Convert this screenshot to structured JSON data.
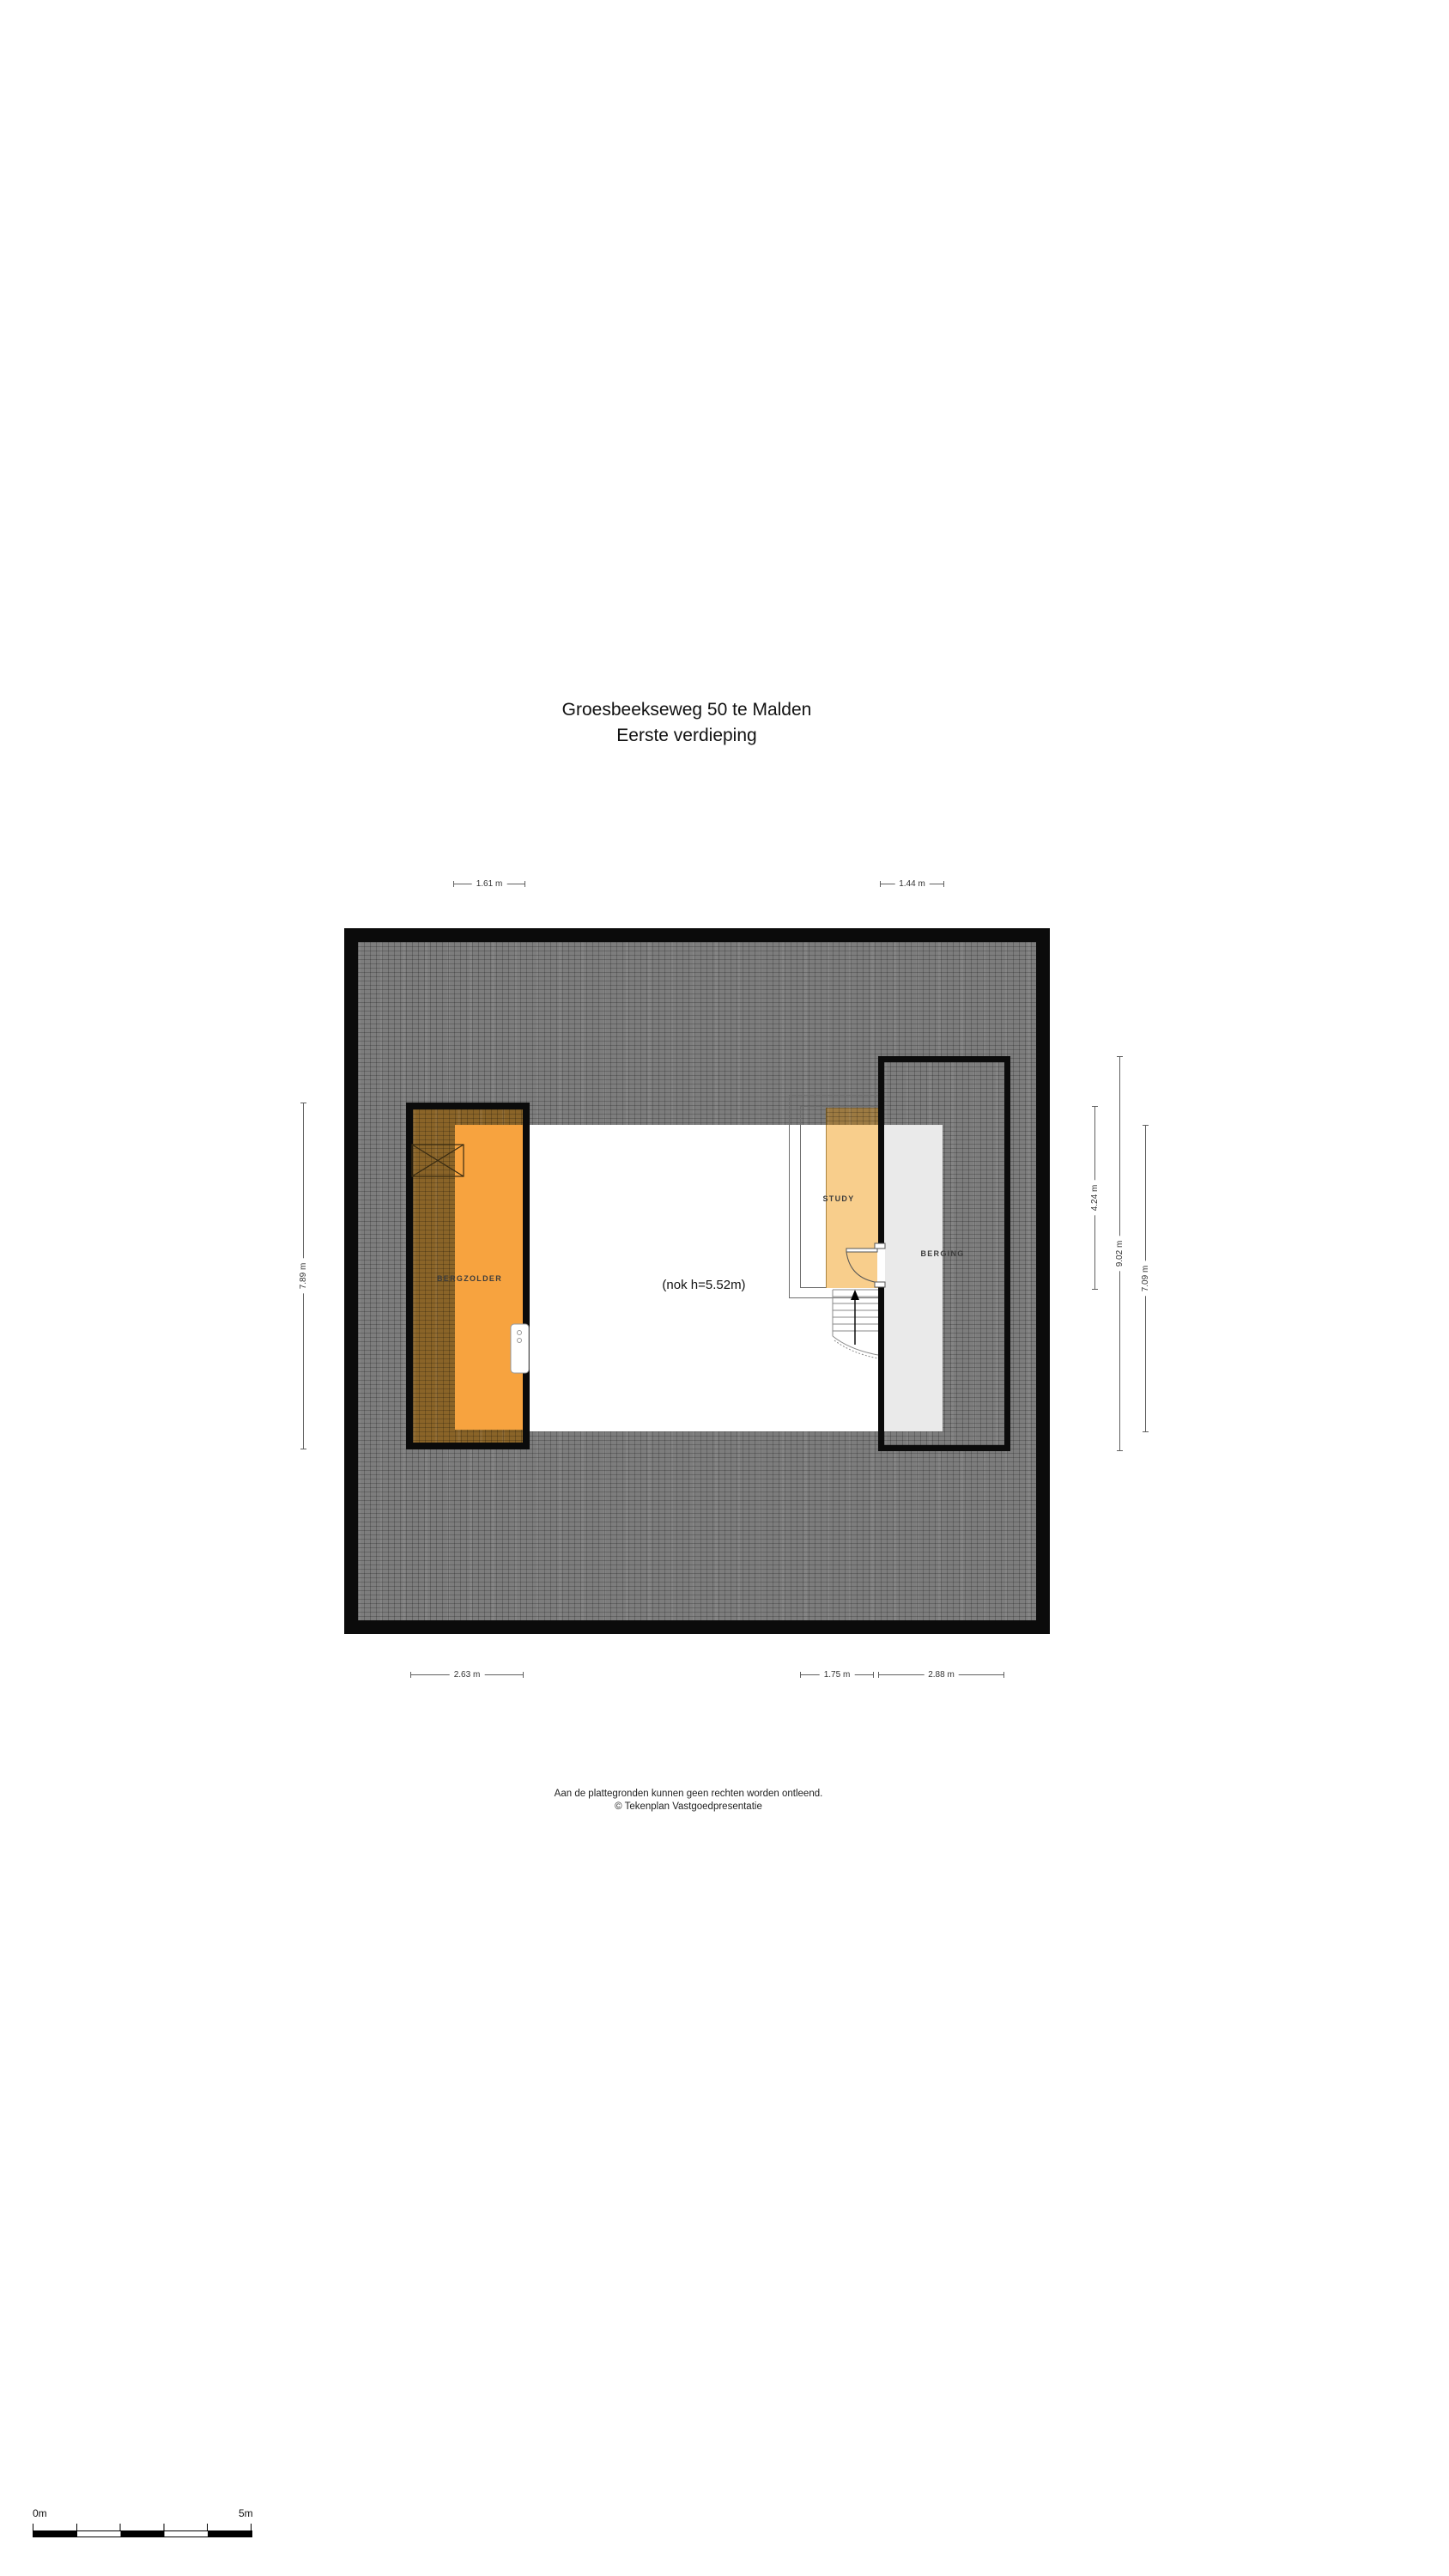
{
  "title": {
    "line1": "Groesbeekseweg 50 te Malden",
    "line2": "Eerste verdieping"
  },
  "plan": {
    "note": "(nok h=5.52m)",
    "rooms": {
      "bergzolder": "BERGZOLDER",
      "study": "STUDY",
      "berging": "BERGING"
    }
  },
  "dimensions": {
    "top_left": "1.61 m",
    "top_right": "1.44 m",
    "left": "7.89 m",
    "right_study": "4.24 m",
    "right_berging": "9.02 m",
    "right_open_area": "7.09 m",
    "bottom_left": "2.63 m",
    "bottom_center": "1.75 m",
    "bottom_right": "2.88 m"
  },
  "footer": {
    "line1": "Aan de plattegronden kunnen geen rechten worden ontleend.",
    "line2": "© Tekenplan Vastgoedpresentatie"
  },
  "scale_bar": {
    "start_label": "0m",
    "end_label": "5m"
  },
  "colors": {
    "wall": "#0b0b0b",
    "roof_hatch_gray": "#7d7d7d",
    "bergzolder_orange": "#f7a33f",
    "roofed_room_orange": "#8a6428",
    "study_orange": "#f8ce8c",
    "berging_gray": "#eaeaea",
    "dimension_line": "#606060"
  }
}
